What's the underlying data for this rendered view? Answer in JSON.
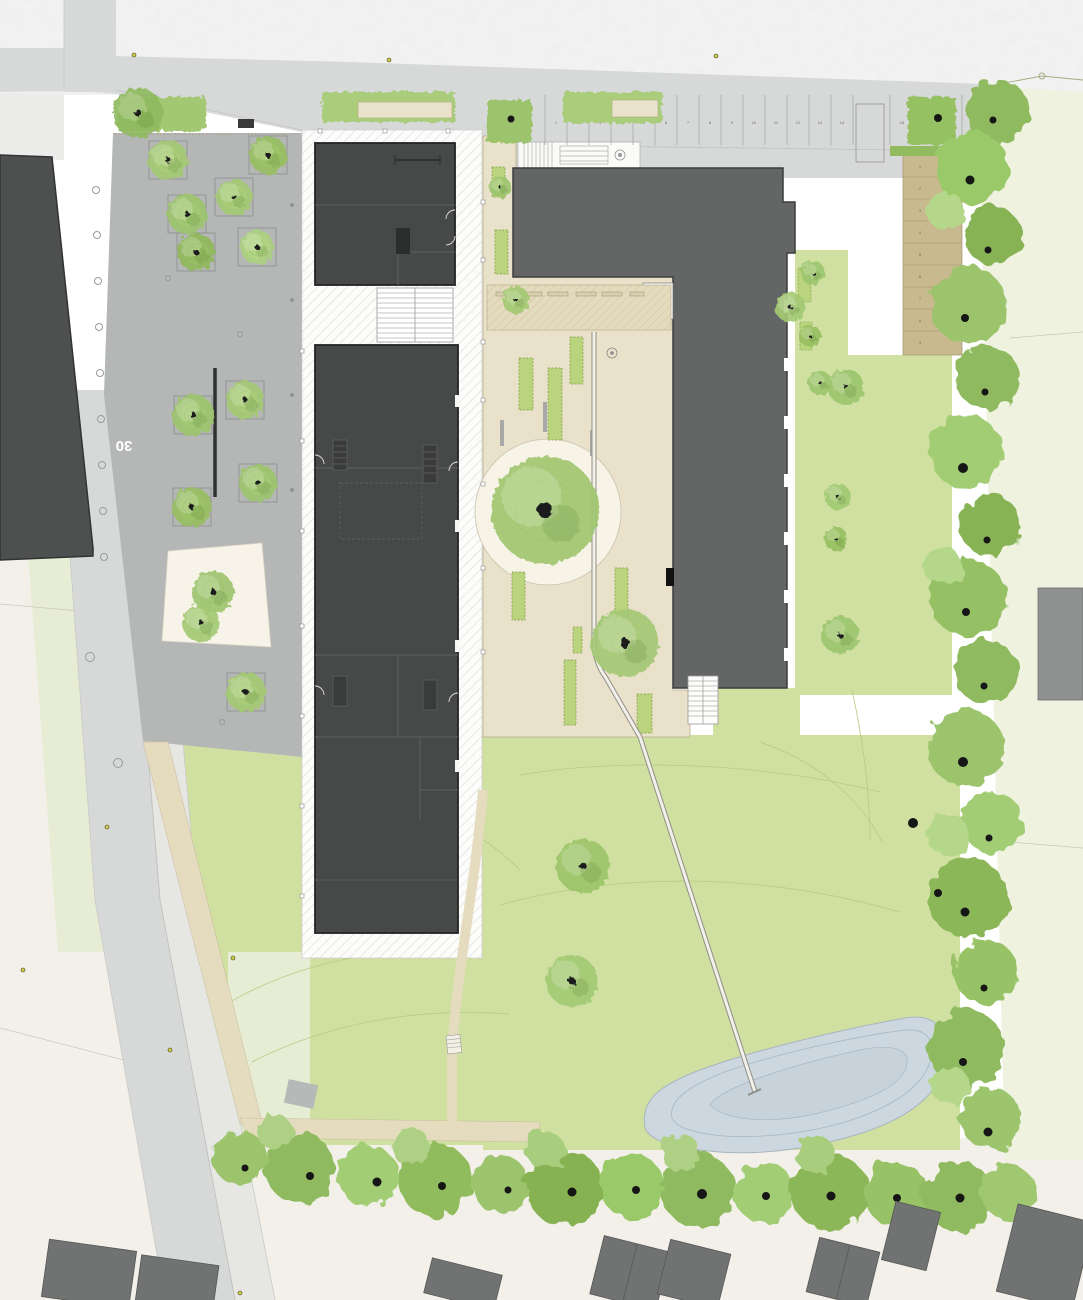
{
  "meta": {
    "title": "Landscape site plan",
    "drawing_type": "architectural site / landscape masterplan"
  },
  "labels": {
    "speed_limit_marking": "30"
  },
  "parking": {
    "top_row": {
      "stalls": [
        "1",
        "2",
        "3",
        "4",
        "5",
        "6",
        "7",
        "8",
        "9",
        "10",
        "11",
        "12",
        "13",
        "14"
      ]
    },
    "top_row_right": {
      "stalls": [
        "15",
        "16",
        "17"
      ]
    },
    "east_column": {
      "stalls": [
        "1",
        "2",
        "3",
        "4",
        "5",
        "6",
        "7",
        "8",
        "9"
      ]
    }
  },
  "colors": {
    "paper": "#f1f2f1",
    "road": "#d7d8d8",
    "sidewalk": "#e6e6e3",
    "plaza": "#b5b6b6",
    "lawn": "#cfe0a0",
    "pale_green": "#e7ecd4",
    "field": "#eef2de",
    "cream": "#f2f0e8",
    "courtyard": "#e9e1c9",
    "white_plaza": "#f7f3e8",
    "tan_parking": "#c8b98e",
    "building_dark": "#474848",
    "building_mid": "#646565",
    "building_left": "#4e4f4f",
    "house": "#717272",
    "pond": "#ccd7df",
    "tree_green": "#9cc46d",
    "hedge_green": "#92bb60",
    "bed_green": "#b9d47c",
    "path_beige": "#e5dcbf"
  }
}
